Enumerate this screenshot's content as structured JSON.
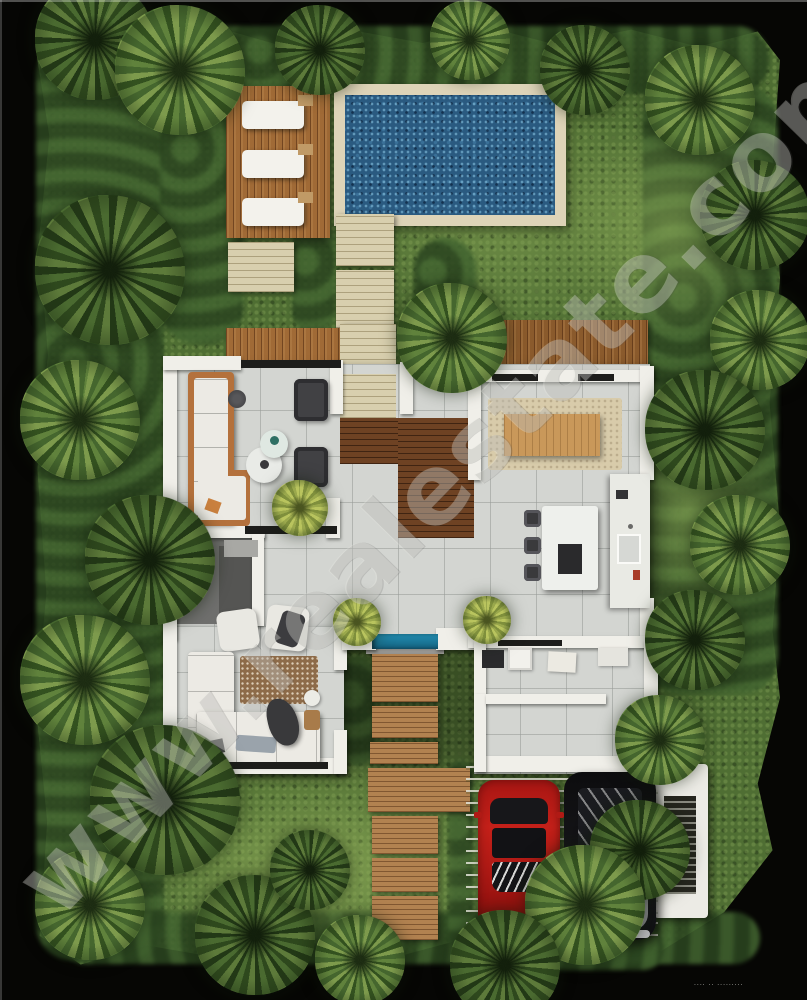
{
  "meta": {
    "title": "Top-down 3D rendered site plan of a tropical villa",
    "style": "photorealistic architectural floor-plan render"
  },
  "watermark": {
    "text": "www.realestate.com",
    "credit_text": "···· ·· ·········"
  },
  "palette": {
    "frame_black": "#060604",
    "lawn_green": "#4f6e33",
    "hedge_green": "#2b4520",
    "pool_water": "#2a5a80",
    "pool_coping": "#ded4b8",
    "deck_wood": "#a06a36",
    "path_beige": "#d8cfae",
    "interior_wood": "#6e4223",
    "walkway_wood": "#b28250",
    "tile_floor": "#d3d5d1",
    "wall_white": "#f0efe9",
    "sofa_frame_wood": "#b4713c",
    "plunge_pool": "#2390b4",
    "red_car": "#c42019",
    "black_car": "#101013"
  },
  "scene": {
    "view": "top-down",
    "rooms": [
      "living-room",
      "bathroom",
      "entry-hall",
      "dining-room",
      "kitchen",
      "family-lounge",
      "utility-room",
      "mudroom"
    ],
    "outdoor": [
      "swimming-pool",
      "sun-deck",
      "stepping-stone-path",
      "timber-walkway",
      "plunge-pool",
      "lawn",
      "palm-garden",
      "carport",
      "slat-privacy-wall"
    ],
    "pool": {
      "loungers": 3
    },
    "dining": {
      "seats": 8
    },
    "kitchen_island": {
      "stools": 3
    },
    "vehicles": [
      {
        "type": "sports-car",
        "color": "#c42019"
      },
      {
        "type": "suv",
        "color": "#101013"
      }
    ]
  }
}
